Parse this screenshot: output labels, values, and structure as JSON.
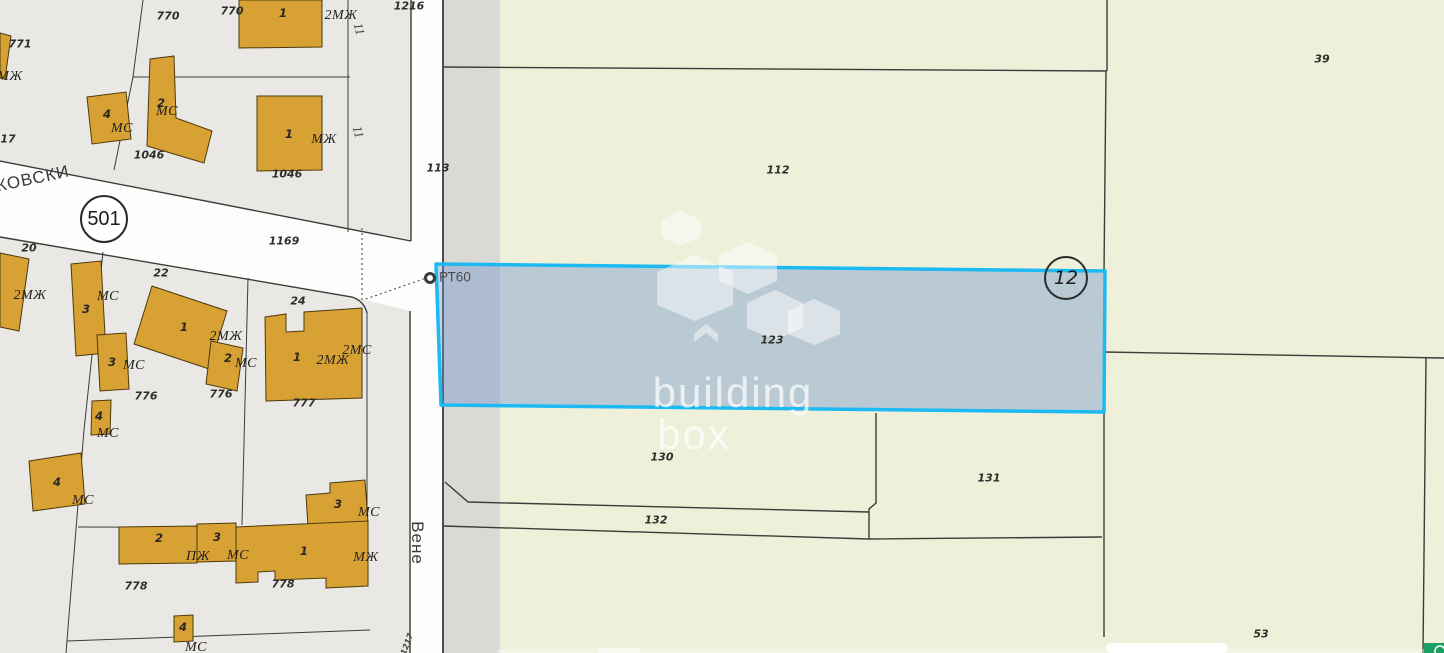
{
  "meta": {
    "view": "cadastral-map",
    "brand_watermark": {
      "line1": "building",
      "line2": "box"
    }
  },
  "colors": {
    "urban_block_gray": "#e9e8e5",
    "road_white": "#fdfdfc",
    "verge_strip_gray": "#d9d9d6",
    "rural_green": "#eef0da",
    "building_fill": "#d8a134",
    "building_stroke": "#4c3a0c",
    "parcel_line": "#3c3c3a",
    "highlight_border": "#1db9f2",
    "highlight_fill": "rgba(108,146,205,0.40)",
    "chat_button_green": "#1d9e63"
  },
  "badges": {
    "road_number": "501",
    "selected_parcel_number": "12"
  },
  "survey_point": {
    "label": "РТ60"
  },
  "map": {
    "labels": [
      {
        "t": "КОВСКИ",
        "x": 33,
        "y": 179,
        "c": "street",
        "r": -12
      },
      {
        "t": "Вене",
        "x": 417,
        "y": 543,
        "c": "street",
        "r": 90
      },
      {
        "t": "РТ60",
        "x": 455,
        "y": 277,
        "c": "pt"
      },
      {
        "t": "770",
        "x": 168,
        "y": 16,
        "c": "num"
      },
      {
        "t": "770",
        "x": 232,
        "y": 11,
        "c": "num"
      },
      {
        "t": "771",
        "x": 20,
        "y": 44,
        "c": "num"
      },
      {
        "t": "1216",
        "x": 409,
        "y": 6,
        "c": "num"
      },
      {
        "t": "1169",
        "x": 284,
        "y": 241,
        "c": "num"
      },
      {
        "t": "1046",
        "x": 149,
        "y": 155,
        "c": "num"
      },
      {
        "t": "1046",
        "x": 287,
        "y": 174,
        "c": "num"
      },
      {
        "t": "17",
        "x": 8,
        "y": 139,
        "c": "num"
      },
      {
        "t": "20",
        "x": 29,
        "y": 248,
        "c": "num"
      },
      {
        "t": "22",
        "x": 161,
        "y": 273,
        "c": "num"
      },
      {
        "t": "24",
        "x": 298,
        "y": 301,
        "c": "num"
      },
      {
        "t": "776",
        "x": 146,
        "y": 396,
        "c": "num"
      },
      {
        "t": "776",
        "x": 221,
        "y": 394,
        "c": "num"
      },
      {
        "t": "777",
        "x": 304,
        "y": 403,
        "c": "num"
      },
      {
        "t": "778",
        "x": 136,
        "y": 586,
        "c": "num"
      },
      {
        "t": "778",
        "x": 283,
        "y": 584,
        "c": "num"
      },
      {
        "t": "113",
        "x": 438,
        "y": 168,
        "c": "num"
      },
      {
        "t": "112",
        "x": 778,
        "y": 170,
        "c": "num"
      },
      {
        "t": "39",
        "x": 1322,
        "y": 59,
        "c": "num"
      },
      {
        "t": "123",
        "x": 772,
        "y": 340,
        "c": "num"
      },
      {
        "t": "130",
        "x": 662,
        "y": 457,
        "c": "num"
      },
      {
        "t": "131",
        "x": 989,
        "y": 478,
        "c": "num"
      },
      {
        "t": "132",
        "x": 656,
        "y": 520,
        "c": "num"
      },
      {
        "t": "53",
        "x": 1261,
        "y": 634,
        "c": "num"
      },
      {
        "t": "11",
        "x": 359,
        "y": 29,
        "c": "mark",
        "r": 75
      },
      {
        "t": "11",
        "x": 358,
        "y": 132,
        "c": "mark",
        "r": 75
      },
      {
        "t": "1217",
        "x": 407,
        "y": 644,
        "c": "tiny",
        "r": -70
      },
      {
        "t": "4",
        "x": 107,
        "y": 114,
        "c": "bnum"
      },
      {
        "t": "2",
        "x": 161,
        "y": 103,
        "c": "bnum"
      },
      {
        "t": "1",
        "x": 283,
        "y": 13,
        "c": "bnum"
      },
      {
        "t": "1",
        "x": 289,
        "y": 134,
        "c": "bnum"
      },
      {
        "t": "3",
        "x": 86,
        "y": 309,
        "c": "bnum"
      },
      {
        "t": "3",
        "x": 112,
        "y": 362,
        "c": "bnum"
      },
      {
        "t": "4",
        "x": 99,
        "y": 416,
        "c": "bnum"
      },
      {
        "t": "1",
        "x": 184,
        "y": 327,
        "c": "bnum"
      },
      {
        "t": "2",
        "x": 228,
        "y": 358,
        "c": "bnum"
      },
      {
        "t": "1",
        "x": 297,
        "y": 357,
        "c": "bnum"
      },
      {
        "t": "4",
        "x": 57,
        "y": 482,
        "c": "bnum"
      },
      {
        "t": "3",
        "x": 338,
        "y": 504,
        "c": "bnum"
      },
      {
        "t": "2",
        "x": 159,
        "y": 538,
        "c": "bnum"
      },
      {
        "t": "3",
        "x": 217,
        "y": 537,
        "c": "bnum"
      },
      {
        "t": "1",
        "x": 304,
        "y": 551,
        "c": "bnum"
      },
      {
        "t": "4",
        "x": 183,
        "y": 627,
        "c": "bnum"
      },
      {
        "t": "МС",
        "x": 122,
        "y": 129,
        "c": "type"
      },
      {
        "t": "МС",
        "x": 167,
        "y": 112,
        "c": "type"
      },
      {
        "t": "МЖ",
        "x": 10,
        "y": 77,
        "c": "type"
      },
      {
        "t": "2МЖ",
        "x": 341,
        "y": 16,
        "c": "type"
      },
      {
        "t": "МЖ",
        "x": 324,
        "y": 140,
        "c": "type"
      },
      {
        "t": "2МЖ",
        "x": 30,
        "y": 296,
        "c": "type"
      },
      {
        "t": "МС",
        "x": 108,
        "y": 297,
        "c": "type"
      },
      {
        "t": "МС",
        "x": 134,
        "y": 366,
        "c": "type"
      },
      {
        "t": "МС",
        "x": 108,
        "y": 434,
        "c": "type"
      },
      {
        "t": "2МЖ",
        "x": 226,
        "y": 337,
        "c": "type"
      },
      {
        "t": "МС",
        "x": 246,
        "y": 364,
        "c": "type"
      },
      {
        "t": "2МЖ",
        "x": 333,
        "y": 361,
        "c": "type"
      },
      {
        "t": "2МС",
        "x": 357,
        "y": 351,
        "c": "type"
      },
      {
        "t": "МС",
        "x": 83,
        "y": 501,
        "c": "type"
      },
      {
        "t": "МС",
        "x": 369,
        "y": 513,
        "c": "type"
      },
      {
        "t": "ПЖ",
        "x": 198,
        "y": 557,
        "c": "type"
      },
      {
        "t": "МС",
        "x": 238,
        "y": 556,
        "c": "type"
      },
      {
        "t": "МЖ",
        "x": 366,
        "y": 558,
        "c": "type"
      },
      {
        "t": "МС",
        "x": 196,
        "y": 648,
        "c": "type"
      }
    ]
  }
}
